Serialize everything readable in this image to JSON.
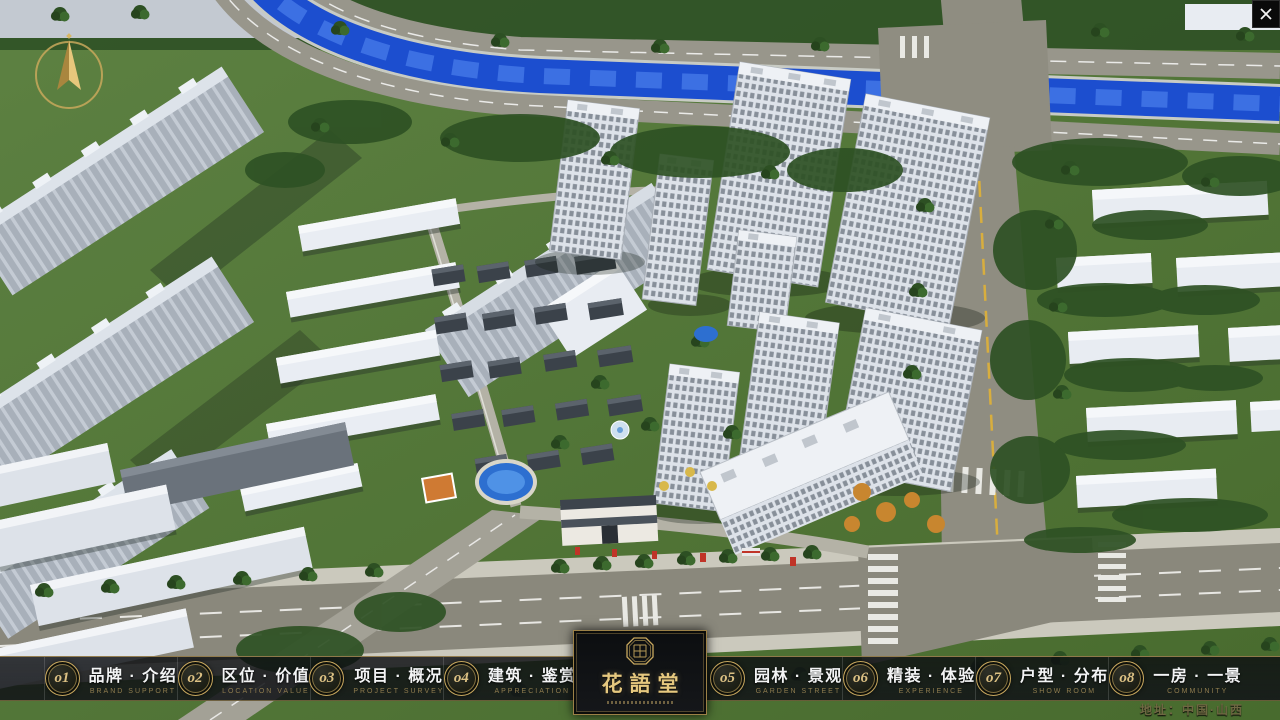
{
  "app": {
    "title": "花語堂 楼盘数字展示系统",
    "address": "地址：中国·山西"
  },
  "logo": {
    "title": "花語堂",
    "seal": "seal-emblem"
  },
  "menu": {
    "items": [
      {
        "num": "o1",
        "label": "品牌 · 介绍",
        "en": "BRAND SUPPORT"
      },
      {
        "num": "o2",
        "label": "区位 · 价值",
        "en": "LOCATION VALUE"
      },
      {
        "num": "o3",
        "label": "项目 · 概况",
        "en": "PROJECT SURVEY"
      },
      {
        "num": "o4",
        "label": "建筑 · 鉴赏",
        "en": "APPRECIATION"
      },
      {
        "num": "o5",
        "label": "园林 · 景观",
        "en": "GARDEN STREET"
      },
      {
        "num": "o6",
        "label": "精装 · 体验",
        "en": "EXPERIENCE"
      },
      {
        "num": "o7",
        "label": "户型 · 分布",
        "en": "SHOW ROOM"
      },
      {
        "num": "o8",
        "label": "一房 · 一景",
        "en": "COMMUNITY"
      }
    ]
  },
  "colors": {
    "accent_gold": "#c7a75e",
    "bar_background": "rgba(12,14,17,0.85)",
    "river_blue": "#1c4ecf",
    "grass_green": "#55793a"
  }
}
